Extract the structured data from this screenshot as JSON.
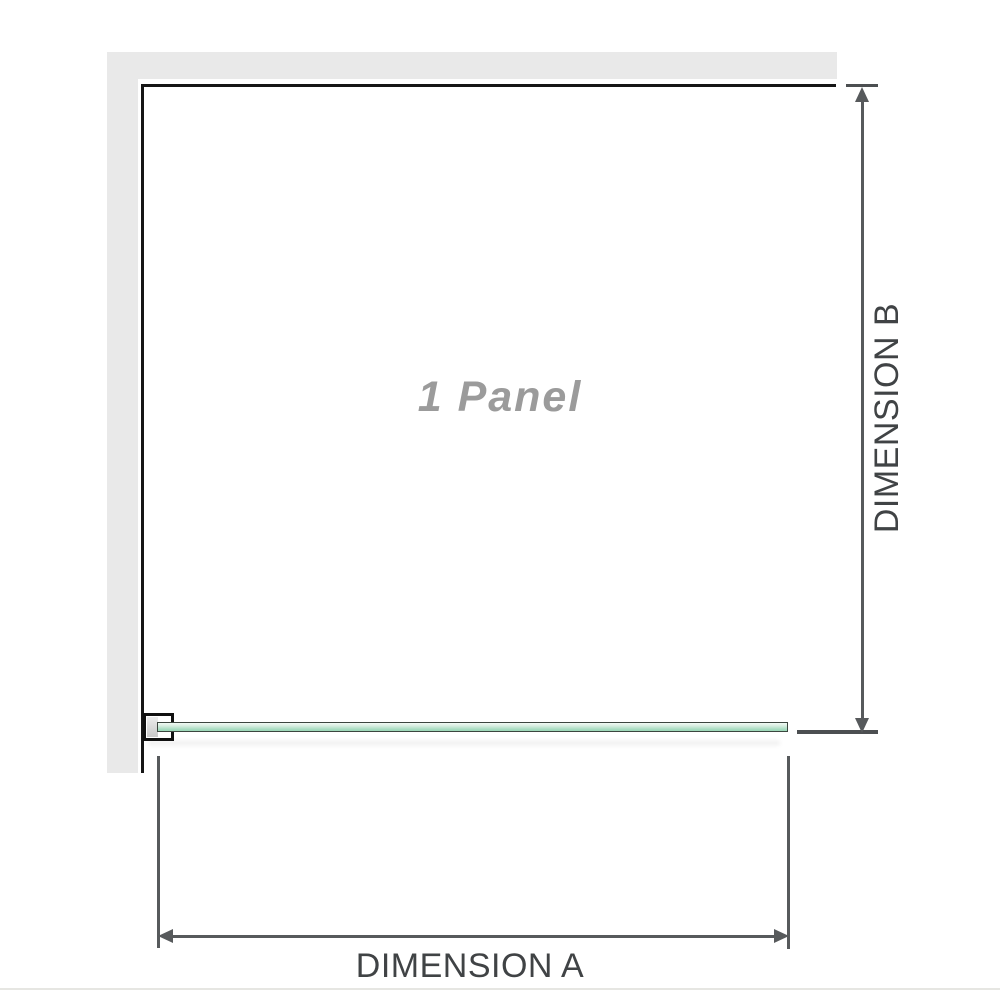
{
  "diagram": {
    "panel_label": "1 Panel",
    "dimension_a_label": "DIMENSION A",
    "dimension_b_label": "DIMENSION B"
  },
  "colors": {
    "background": "#ffffff",
    "wall_fill": "#e9e9e9",
    "wall_edge": "#161616",
    "glass_outline": "#3c463f",
    "glass_fill_light": "#f2faf4",
    "glass_fill_green": "#9bd6b6",
    "bracket_border": "#101010",
    "bracket_fill": "#ffffff",
    "bracket_insert": "#c9c9c9",
    "dimension_line": "#575a5c",
    "dimension_tick": "#4c4f51",
    "dimension_text": "#404345",
    "panel_text": "#9b9b9b",
    "bottom_divider": "#e6e6e2"
  }
}
